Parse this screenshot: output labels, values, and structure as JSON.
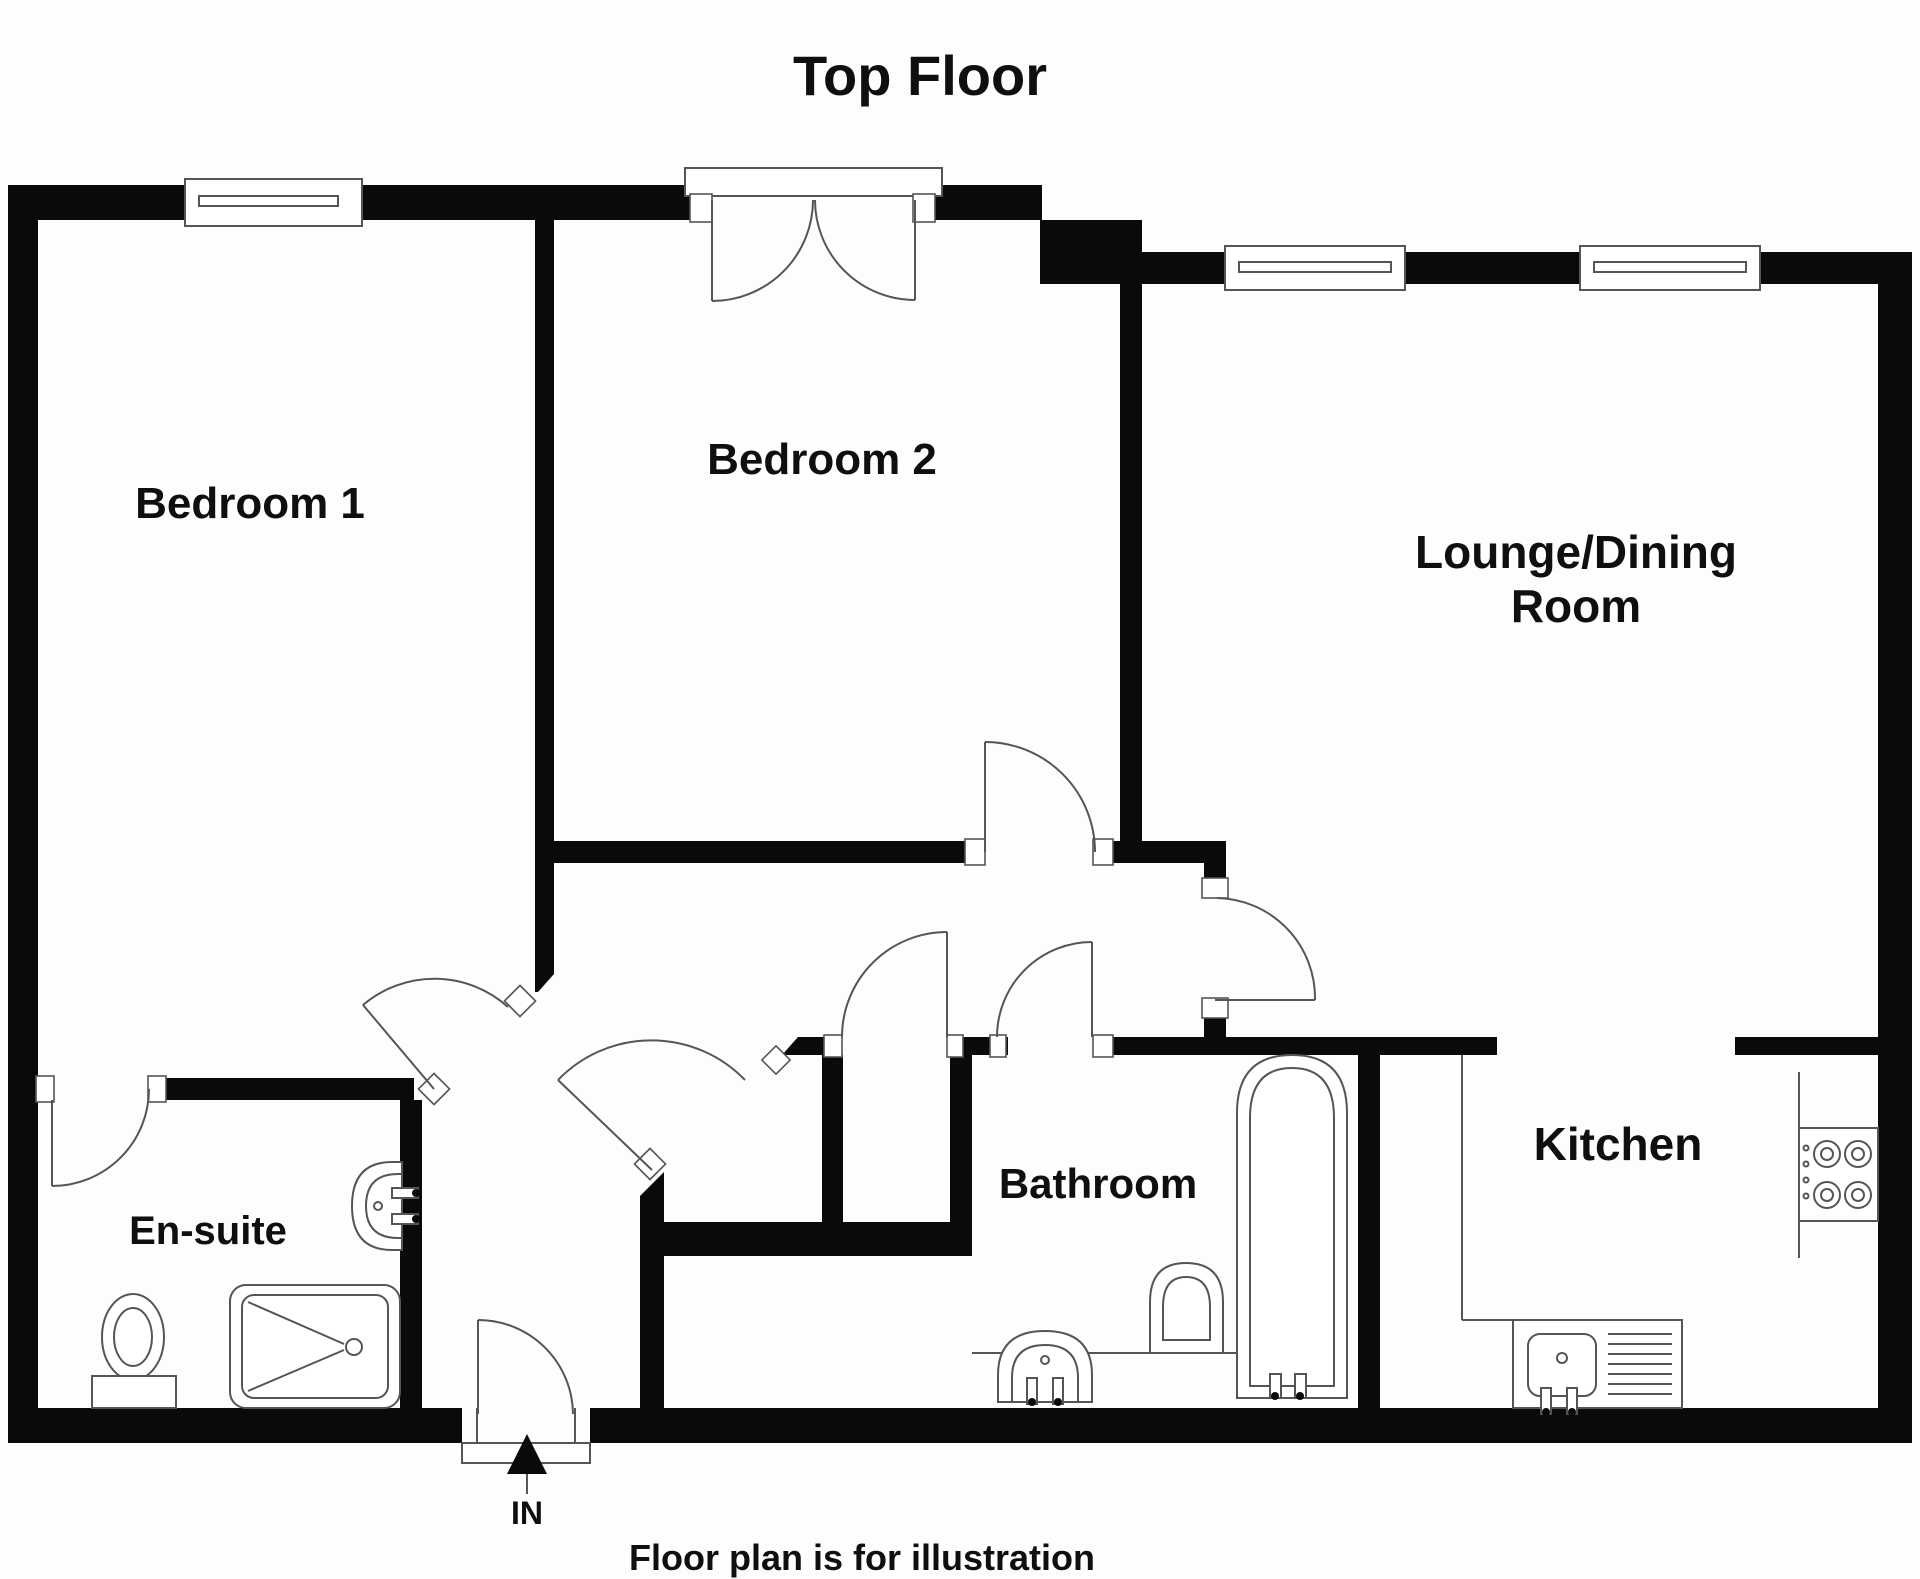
{
  "title": "Top Floor",
  "footer_note": "Floor plan is for illustration",
  "entrance": {
    "label": "IN"
  },
  "rooms": {
    "bedroom1": {
      "label": "Bedroom 1"
    },
    "bedroom2": {
      "label": "Bedroom 2"
    },
    "lounge": {
      "label_line1": "Lounge/Dining",
      "label_line2": "Room"
    },
    "ensuite": {
      "label": "En-suite"
    },
    "bathroom": {
      "label": "Bathroom"
    },
    "kitchen": {
      "label": "Kitchen"
    }
  },
  "colors": {
    "wall": "#0a0a0a",
    "thin_line": "#555555",
    "background": "#fdfdfd",
    "text": "#0f0f0f"
  }
}
